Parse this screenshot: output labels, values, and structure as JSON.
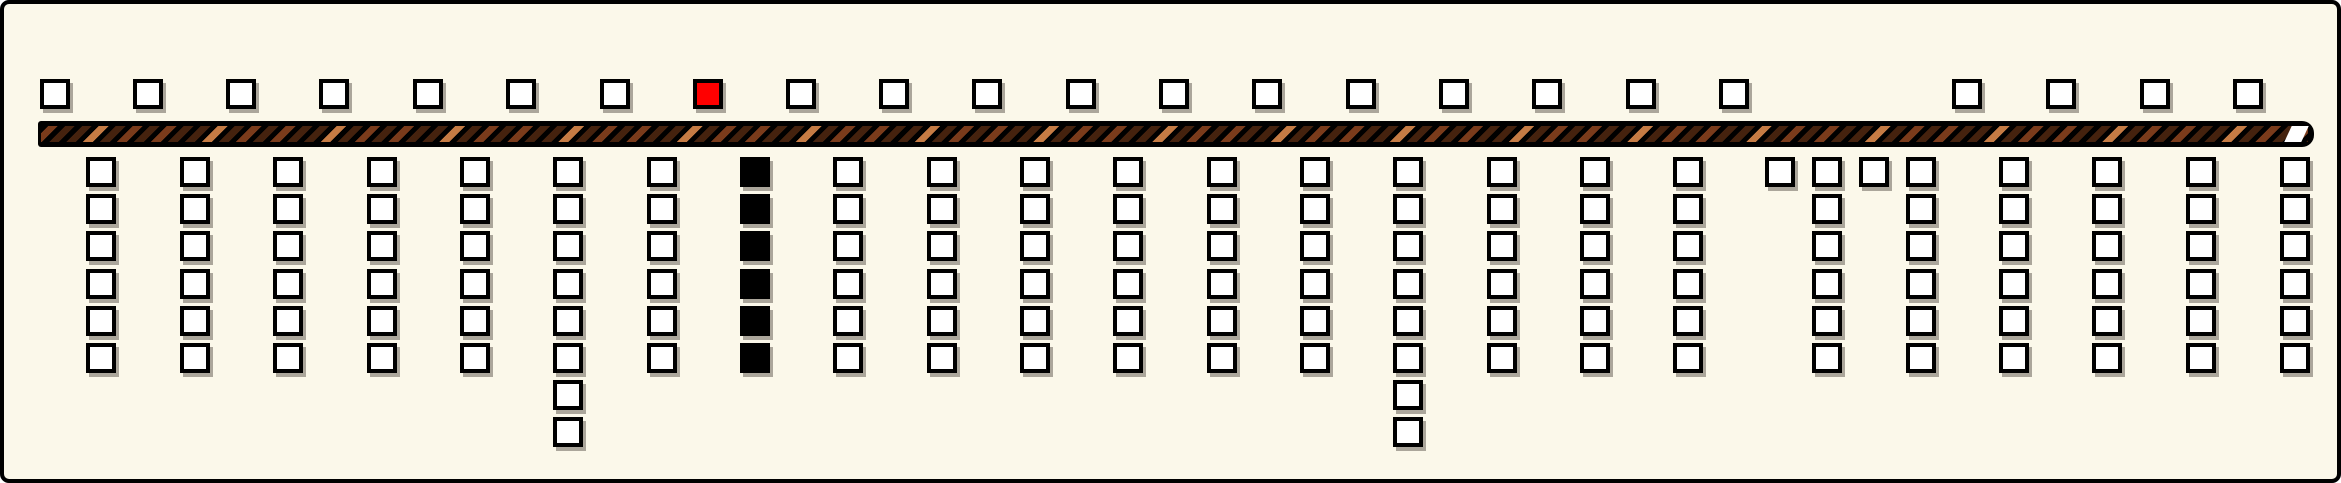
{
  "palette": {
    "page_background": "#ffffff",
    "board_background": "#fbf8ea",
    "outline": "#000000",
    "box_fill": "#ffffff",
    "selected_fill": "#ff0000",
    "filled_stack_fill": "#000000",
    "box_shadow": "#aba69b",
    "stripe_medium": "#7a3b1b",
    "stripe_dark": "#45220e",
    "stripe_light": "#c57b44",
    "bar_end_segment": "#ffffff"
  },
  "board": {
    "width": 2341,
    "height": 483,
    "top_row": {
      "y": 75,
      "box_size": 30,
      "selected_index": 7,
      "slots_x": [
        51,
        144,
        237,
        330,
        424,
        517,
        611,
        704,
        797,
        890,
        983,
        1077,
        1170,
        1263,
        1357,
        1450,
        1543,
        1637,
        1730,
        1963,
        2057,
        2151,
        2244
      ]
    },
    "bar": {
      "x": 34,
      "y": 117,
      "width": 2276,
      "height": 26
    },
    "stacks": {
      "first_row_y": 153,
      "row_pitch": 37.2,
      "box_size": 30,
      "columns": [
        {
          "x": 97,
          "count": 6,
          "fill": "white"
        },
        {
          "x": 191,
          "count": 6,
          "fill": "white"
        },
        {
          "x": 284,
          "count": 6,
          "fill": "white"
        },
        {
          "x": 378,
          "count": 6,
          "fill": "white"
        },
        {
          "x": 471,
          "count": 6,
          "fill": "white"
        },
        {
          "x": 564,
          "count": 8,
          "fill": "white"
        },
        {
          "x": 658,
          "count": 6,
          "fill": "white"
        },
        {
          "x": 751,
          "count": 6,
          "fill": "black"
        },
        {
          "x": 844,
          "count": 6,
          "fill": "white"
        },
        {
          "x": 938,
          "count": 6,
          "fill": "white"
        },
        {
          "x": 1031,
          "count": 6,
          "fill": "white"
        },
        {
          "x": 1124,
          "count": 6,
          "fill": "white"
        },
        {
          "x": 1218,
          "count": 6,
          "fill": "white"
        },
        {
          "x": 1311,
          "count": 6,
          "fill": "white"
        },
        {
          "x": 1404,
          "count": 8,
          "fill": "white"
        },
        {
          "x": 1498,
          "count": 6,
          "fill": "white"
        },
        {
          "x": 1591,
          "count": 6,
          "fill": "white"
        },
        {
          "x": 1684,
          "count": 6,
          "fill": "white"
        },
        {
          "x": 1776,
          "count": 1,
          "fill": "white"
        },
        {
          "x": 1823,
          "count": 6,
          "fill": "white"
        },
        {
          "x": 1870,
          "count": 1,
          "fill": "white"
        },
        {
          "x": 1917,
          "count": 6,
          "fill": "white"
        },
        {
          "x": 2010,
          "count": 6,
          "fill": "white"
        },
        {
          "x": 2103,
          "count": 6,
          "fill": "white"
        },
        {
          "x": 2197,
          "count": 6,
          "fill": "white"
        },
        {
          "x": 2291,
          "count": 6,
          "fill": "white"
        }
      ]
    }
  }
}
